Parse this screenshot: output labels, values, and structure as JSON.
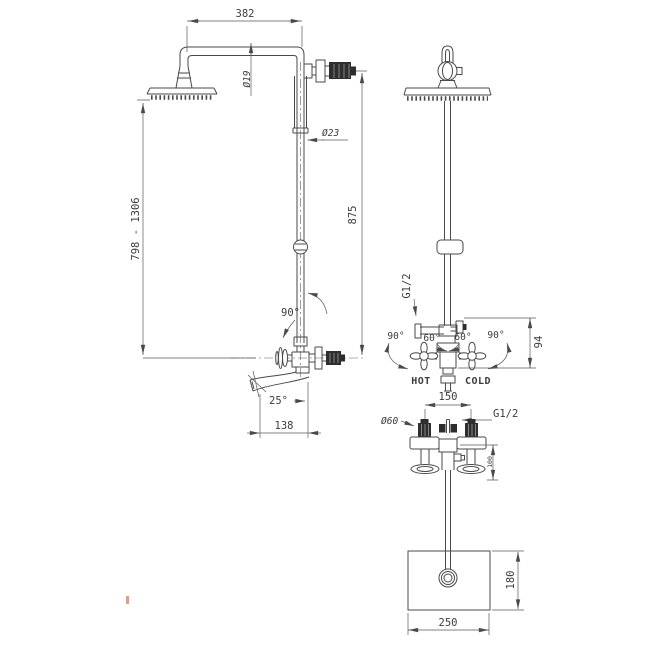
{
  "colors": {
    "background": "#ffffff",
    "line": "#4a4a4a",
    "dim_line": "#5a5a5a",
    "text": "#3c3c3c",
    "dark_fill": "#2e2e2e",
    "stripe": "#9a9a9a",
    "artifact_red": "#c0503a"
  },
  "side_view": {
    "dims": {
      "arm_length": "382",
      "arm_diameter": "Ø19",
      "pipe_diameter": "Ø23",
      "height_range": "798 - 1306",
      "riser_height": "875",
      "swivel_angle": "90°",
      "spout_angle": "25°",
      "spout_reach": "138"
    }
  },
  "front_view": {
    "dims": {
      "inlet_thread": "G1/2",
      "angle_left_outer": "90°",
      "angle_left_inner": "60°",
      "angle_right_inner": "60°",
      "angle_right_outer": "90°",
      "body_height": "94"
    },
    "labels": {
      "hot": "HOT",
      "cold": "COLD"
    }
  },
  "bottom_view": {
    "dims": {
      "handle_spacing": "150",
      "flange_diameter": "Ø60",
      "outlet_thread": "G1/2",
      "depth": "100"
    }
  },
  "wall_box_view": {
    "dims": {
      "height": "180",
      "width": "250"
    }
  }
}
